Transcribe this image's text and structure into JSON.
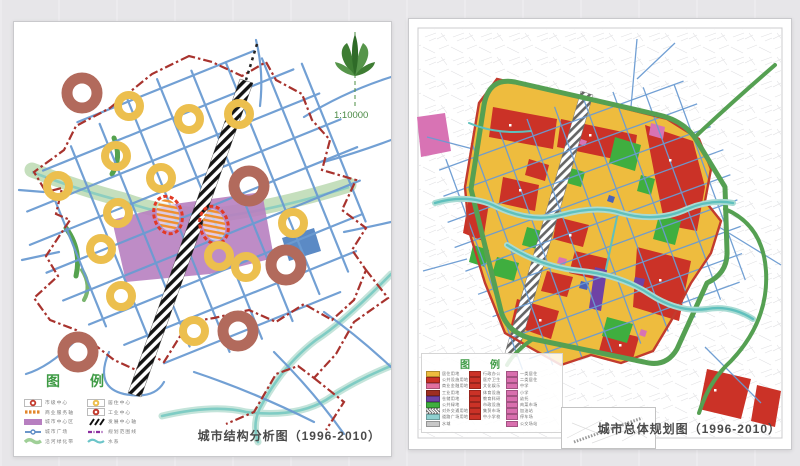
{
  "page": {
    "background": "#e8e7ea"
  },
  "left_map": {
    "title": "城市结构分析图（1996-2010）",
    "scale_label": "1:10000",
    "legend_title": "图例",
    "legend": {
      "col1": [
        {
          "label": "市级中心",
          "swatch": "red-ring-box",
          "color": "#c23b2e"
        },
        {
          "label": "商业服务轴",
          "swatch": "orange-dash-line",
          "color": "#e2862b"
        },
        {
          "label": "城市中心区",
          "swatch": "purple-rect",
          "color": "#b77fc0"
        },
        {
          "label": "城市广场",
          "swatch": "blue-line-node",
          "color": "#5b8ac5"
        },
        {
          "label": "沿河绿化带",
          "swatch": "green-wave",
          "color": "#9fcf97"
        }
      ],
      "col2": [
        {
          "label": "居住中心",
          "swatch": "yellow-ring-box",
          "color": "#ecbf4e"
        },
        {
          "label": "工业中心",
          "swatch": "red-ring-box2",
          "color": "#c23b2e"
        },
        {
          "label": "发展中心轴",
          "swatch": "black-hatch",
          "color": "#1a1a1a"
        },
        {
          "label": "规划范围线",
          "swatch": "purple-dash-line",
          "color": "#8b2fa0"
        },
        {
          "label": "水系",
          "swatch": "teal-wave",
          "color": "#6cc5c9"
        }
      ]
    },
    "colors": {
      "roads": "#6b9bd2",
      "boundary": "#a8332e",
      "green_belt": "#b6d7ad",
      "river": "#7fccc4",
      "central_district": "#b77fc0",
      "development_axis": "#1a1a1a",
      "residential_center": "#ecbf4e",
      "industrial_center": "#b26a5c",
      "plaza_block": "#5b8ac5",
      "compass_green": "#3e7d33"
    }
  },
  "right_map": {
    "title": "城市总体规划图（1996-2010）",
    "legend_title": "图例",
    "legend": {
      "col1": [
        {
          "label": "居住用地",
          "color": "#eebc3e"
        },
        {
          "label": "公共设施用地",
          "color": "#cb3227"
        },
        {
          "label": "商业金融用地",
          "color": "#e2709f"
        },
        {
          "label": "工业用地",
          "color": "#9e2e22"
        },
        {
          "label": "仓储用地",
          "color": "#6f42a5"
        },
        {
          "label": "公共绿地",
          "color": "#3fae3f"
        },
        {
          "label": "对外交通用地",
          "color": "#9a9a9a"
        },
        {
          "label": "道路广场用地",
          "color": "#8fd0d0"
        },
        {
          "label": "水域",
          "color": "#c7c7c7"
        }
      ],
      "col2": {
        "color": "#cb3227",
        "items": [
          "行政办公",
          "医疗卫生",
          "文化娱乐",
          "体育设施",
          "教育科研",
          "市政设施",
          "集贸市场",
          "中小学校",
          ""
        ]
      },
      "col3": {
        "color": "#d96fae",
        "items": [
          "一类居住",
          "二类居住",
          "中学",
          "小学",
          "幼托",
          "肉菜市场",
          "加油站",
          "停车场",
          "公交场站"
        ]
      }
    },
    "colors": {
      "residential": "#eebc3e",
      "public_facility": "#cb3227",
      "green_space": "#3fae3f",
      "ring_road": "#55a052",
      "roads": "#6b9bd2",
      "river": "#5fc0bd",
      "boundary": "#c23b2e",
      "pink_area": "#d873b4",
      "purple_area": "#6f42a5"
    }
  }
}
